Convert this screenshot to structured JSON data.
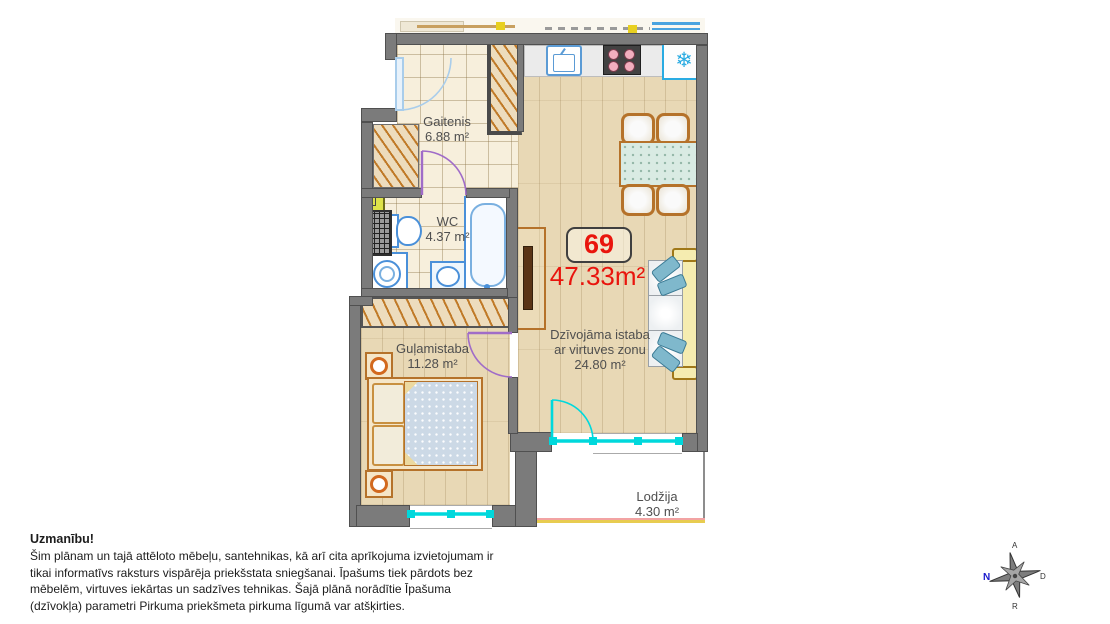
{
  "plan": {
    "unit_badge": "69",
    "total_area": "47.33m²",
    "rooms": {
      "hallway": {
        "name": "Gaitenis",
        "area": "6.88 m²"
      },
      "wc": {
        "name": "WC",
        "area": "4.37 m²"
      },
      "bedroom": {
        "name": "Guļamistaba",
        "area": "11.28 m²"
      },
      "living": {
        "name": "Dzīvojāma istaba",
        "subtitle": "ar virtuves zonu",
        "area": "24.80 m²"
      },
      "loggia": {
        "name": "Lodžija",
        "area": "4.30 m²"
      }
    },
    "icons": {
      "fridge": "❄"
    }
  },
  "compass": {
    "left": "N",
    "top": "A",
    "right": "D",
    "bottom": "R"
  },
  "disclaimer": {
    "title": "Uzmanību!",
    "lines": [
      "Šim plānam un tajā attēloto mēbeļu, santehnikas, kā arī cita aprīkojuma izvietojumam ir",
      "tikai informatīvs raksturs vispārēja priekšstata sniegšanai. Īpašums tiek pārdots bez",
      "mēbelēm, virtuves iekārtas un sadzīves tehnikas. Šajā plānā norādītie Īpašuma",
      "(dzīvokļa) parametri Pirkuma priekšmeta pirkuma līgumā var atšķirties."
    ]
  },
  "colors": {
    "wall": "#7b7b7b",
    "accent_red": "#e9150d",
    "window_cyan": "#00d8dc",
    "door_purple": "#a06cc8",
    "entrance_blue": "#a9cdeb",
    "furniture_brown": "#b5722a",
    "wood_floor": "#e8d8b5",
    "tile_floor": "#f7efdc",
    "fridge_blue": "#29abe2"
  }
}
